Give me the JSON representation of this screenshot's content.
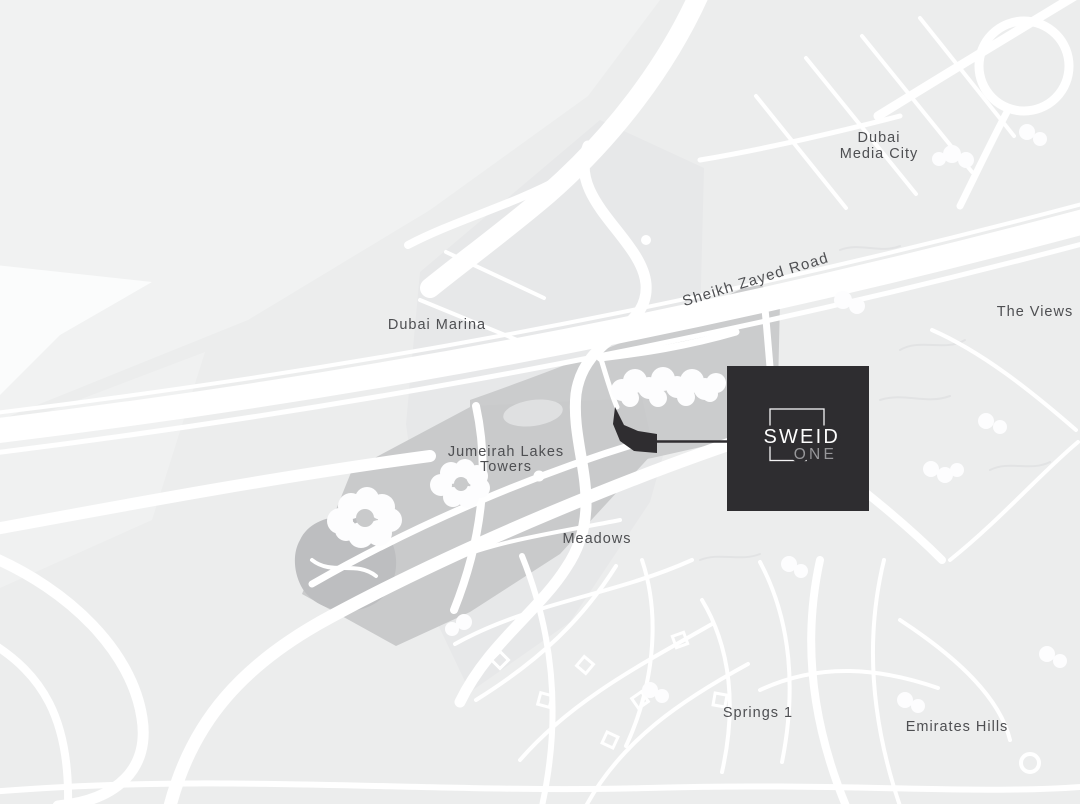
{
  "map": {
    "labels": {
      "dubai_media_city_line1": "Dubai",
      "dubai_media_city_line2": "Media City",
      "sheikh_zayed_road": "Sheikh Zayed Road",
      "dubai_marina": "Dubai Marina",
      "the_views": "The Views",
      "jumeirah_lakes_towers_line1": "Jumeirah Lakes",
      "jumeirah_lakes_towers_line2": "Towers",
      "meadows": "Meadows",
      "springs_1": "Springs 1",
      "emirates_hills": "Emirates Hills"
    },
    "colors": {
      "map_base": "#eceded",
      "map_light_patch": "#f1f2f2",
      "sea_white": "#fbfcfc",
      "road_white": "#ffffff",
      "district_dark_gray": "#c9cacb",
      "median_gray": "#cbcccd",
      "marina_wedge_gray": "#e7e8e9",
      "golf_lake_gray": "#bdbec0",
      "label_text": "#4e4f52",
      "marker_dark": "#2f2d30",
      "logo_background": "#2e2d30",
      "logo_text_primary": "#fdfdfd",
      "logo_text_secondary": "#97979a"
    },
    "logo": {
      "line1": "SWEID",
      "line2": "ONE"
    }
  }
}
